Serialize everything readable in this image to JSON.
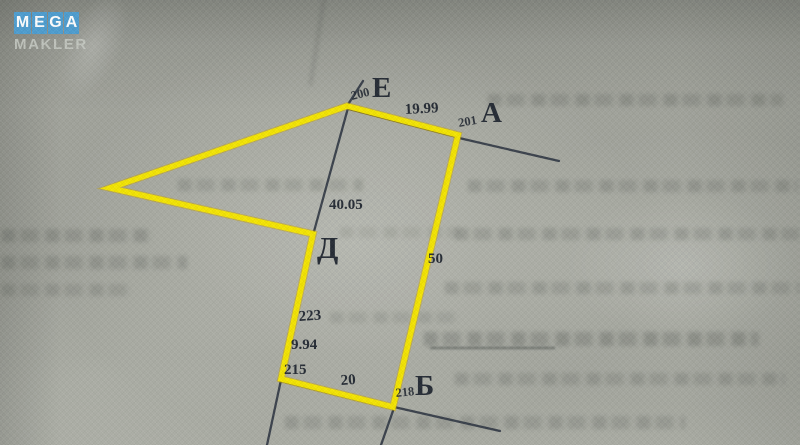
{
  "watermark": {
    "letters": [
      "M",
      "E",
      "G",
      "A"
    ],
    "line2": "MAKLER",
    "tile_color": "#4f9ed0",
    "letter_color": "#ffffff",
    "line2_color": "#c9cdc6"
  },
  "plan": {
    "ink_color": "#2b3340",
    "highlight_color": "#f8e800",
    "vertices": {
      "e": {
        "letter": "Е",
        "point_number": "200"
      },
      "a": {
        "letter": "А",
        "point_number": "201"
      },
      "b": {
        "letter": "Б",
        "point_number": "218"
      },
      "d": {
        "letter": "Д"
      }
    },
    "boundary_points": {
      "p223": "223",
      "p215": "215"
    },
    "lengths": {
      "e_to_a": "19.99",
      "e_to_d": "40.05",
      "a_to_b": "50",
      "p223_to_p215": "9.94",
      "bottom": "20"
    }
  }
}
